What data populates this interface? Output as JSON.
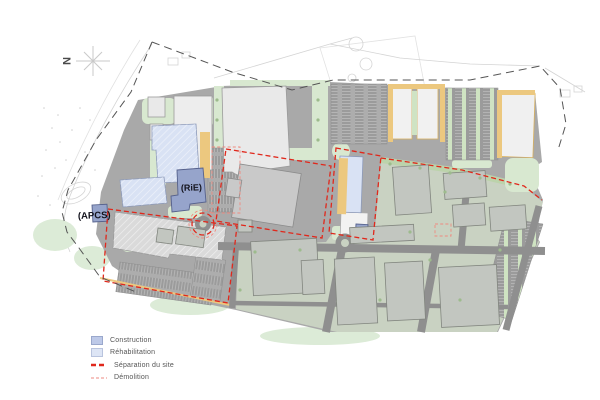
{
  "north": {
    "label": "N"
  },
  "labels": {
    "rie": "(RiE)",
    "apcs": "(APCS)"
  },
  "legend": {
    "items": [
      {
        "label": "Construction",
        "type": "fill"
      },
      {
        "label": "Réhabilitation",
        "type": "fill"
      },
      {
        "label": "Séparation du site",
        "type": "dash-bold"
      },
      {
        "label": "Démolition",
        "type": "dash-thin"
      }
    ]
  },
  "colors": {
    "construction_swatch": "#bdc9e8",
    "rehabilitation_swatch": "#dde5f5",
    "separation": "#e0281c",
    "demolition": "#ee8a80",
    "construction_building": "#96a4cb",
    "rehabilitation_building": "#d9e2f4"
  }
}
